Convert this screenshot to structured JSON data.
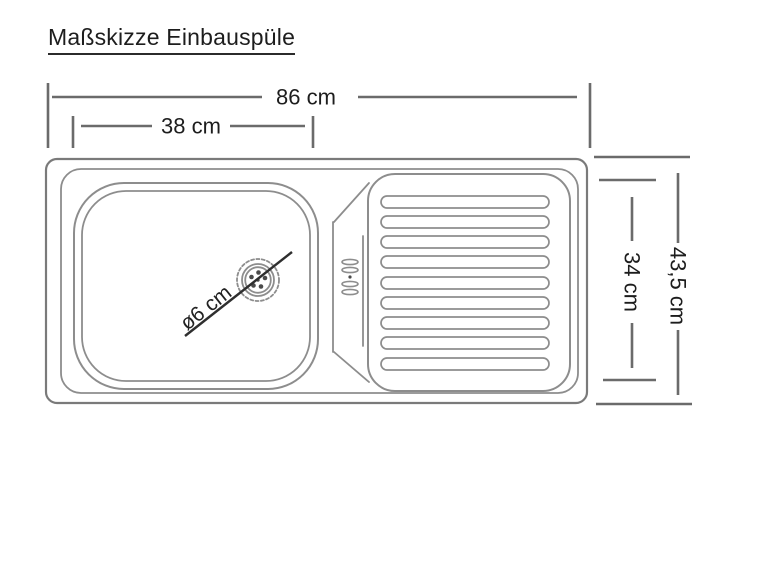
{
  "page": {
    "background": "#ffffff"
  },
  "title": {
    "text": "Maßskizze Einbauspüle"
  },
  "colors": {
    "text": "#1d1d1d",
    "dimension_line": "#6b6b6b",
    "drawing_line": "#8d8d8d",
    "drawing_line_dark": "#7a7a7a",
    "drain_pointer_line": "#2e2e2e"
  },
  "dimensions": {
    "total_width": "86 cm",
    "basin_width": "38 cm",
    "total_depth": "43,5 cm",
    "inner_depth": "34 cm",
    "drain_diameter": "ø6 cm"
  }
}
